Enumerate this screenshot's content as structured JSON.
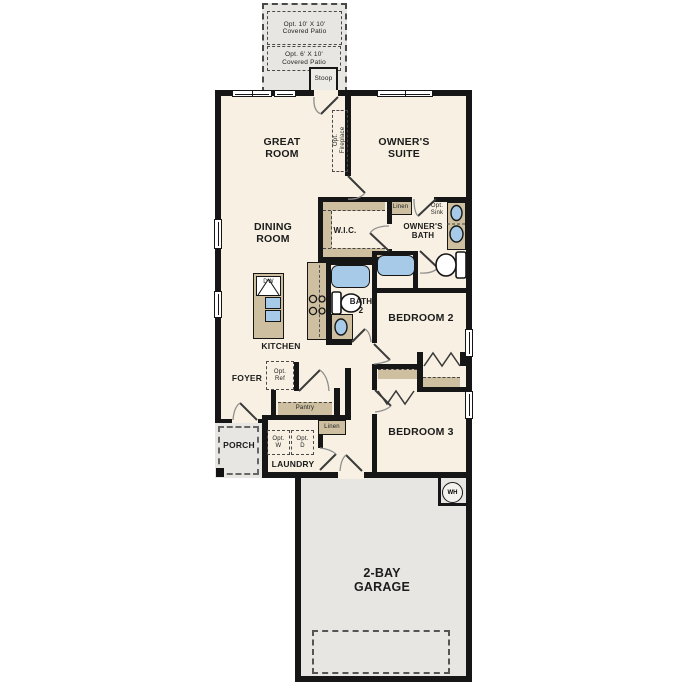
{
  "colors": {
    "wall": "#161616",
    "floor": "#f8f1e3",
    "exterior": "#e8e6e2",
    "cabinet": "#cdbfa0",
    "fixture_blue": "#a6cae8"
  },
  "labels": {
    "patio_upper": "Opt. 10' X 10'\nCovered Patio",
    "patio_lower": "Opt. 6' X 10'\nCovered Patio",
    "stoop": "Stoop",
    "great_room": "GREAT\nROOM",
    "owners_suite": "OWNER'S\nSUITE",
    "opt_fireplace": "Opt.\nFireplace",
    "dining_room": "DINING\nROOM",
    "wic": "W.I.C.",
    "linen_upper": "Linen",
    "opt_sink": "Opt.\nSink",
    "owners_bath": "OWNER'S\nBATH",
    "bath2": "BATH\n2",
    "bedroom2": "BEDROOM 2",
    "bedroom3": "BEDROOM 3",
    "kitchen": "KITCHEN",
    "dw": "DW",
    "foyer": "FOYER",
    "opt_ref": "Opt.\nRef",
    "pantry": "Pantry",
    "linen_lower": "Linen",
    "porch": "PORCH",
    "opt_w": "Opt.\nW",
    "opt_d": "Opt.\nD",
    "laundry": "LAUNDRY",
    "garage": "2-BAY\nGARAGE",
    "wh": "WH"
  }
}
